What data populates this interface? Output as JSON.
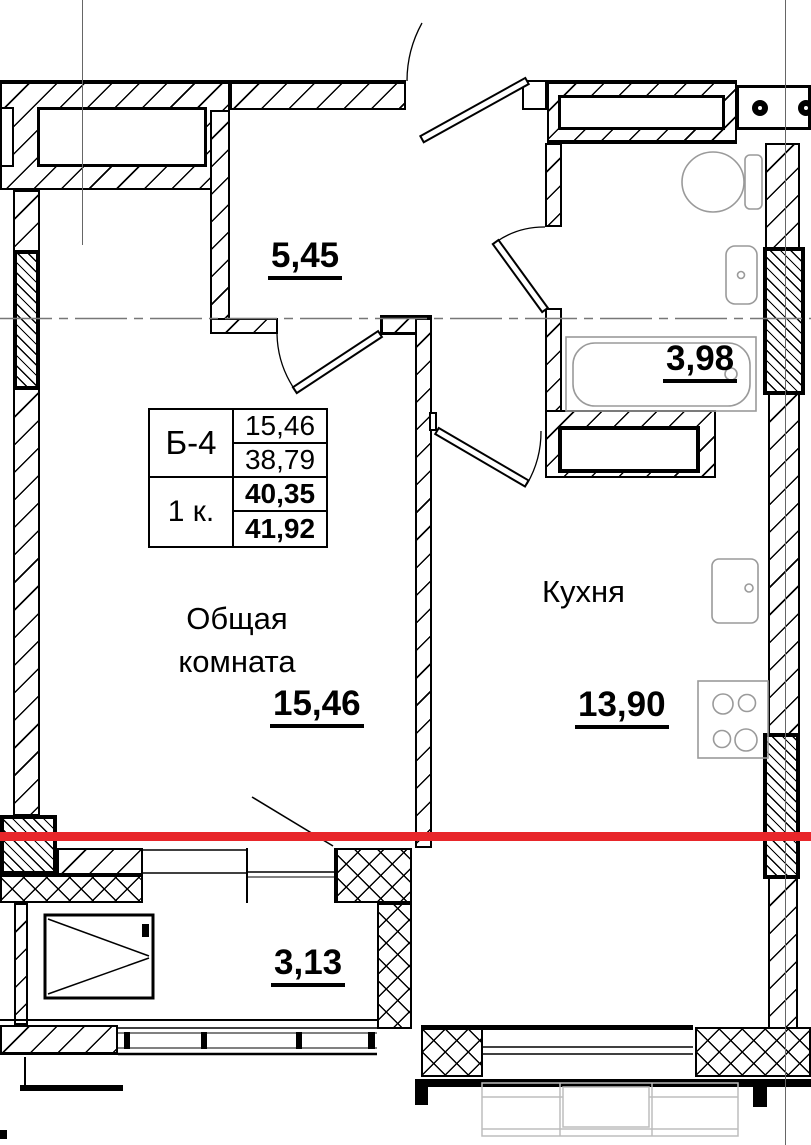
{
  "unit_card": {
    "unit": "Б-4",
    "type": "1 к.",
    "value_1": "15,46",
    "value_2": "38,79",
    "value_3": "40,35",
    "value_4": "41,92"
  },
  "rooms": {
    "hall": {
      "area": "5,45"
    },
    "bath": {
      "area": "3,98"
    },
    "living": {
      "name": "Общая комната",
      "area": "15,46"
    },
    "kitchen": {
      "name": "Кухня",
      "area": "13,90"
    },
    "balcony": {
      "area": "3,13"
    }
  },
  "colors": {
    "section_line": "#e8262a",
    "drawing": "#000000",
    "fixtures": "#9a9a9a",
    "faint": "#bdbdbd",
    "grid": "#666666"
  }
}
